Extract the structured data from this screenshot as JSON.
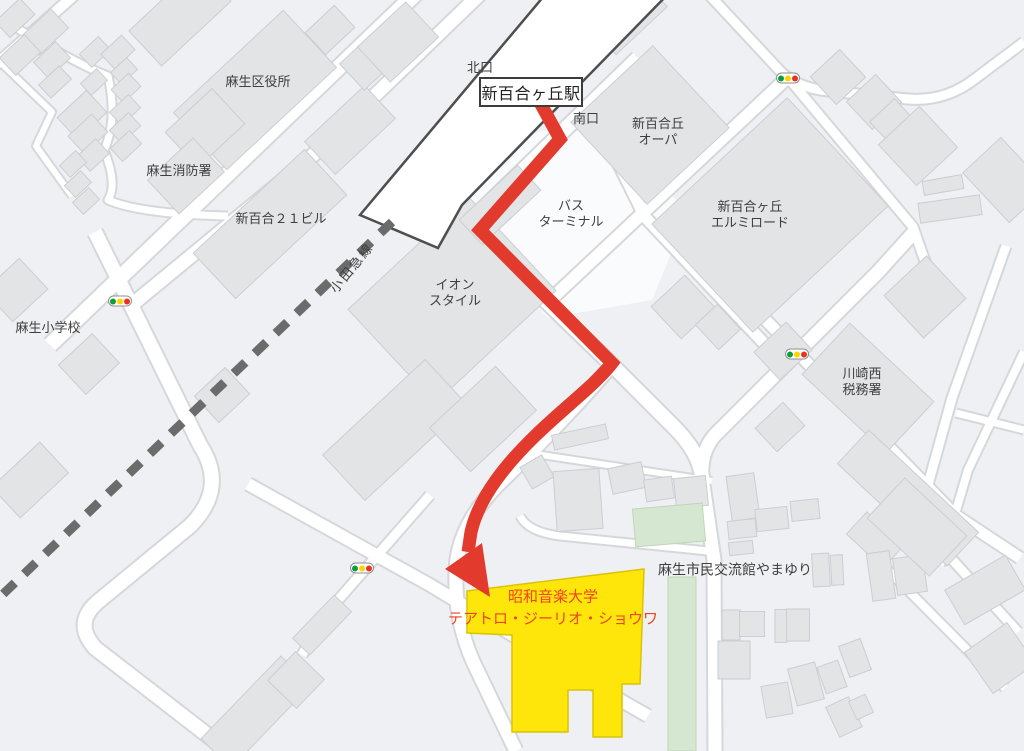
{
  "map_title": "新百合ヶ丘駅から昭和音楽大学への地図",
  "station": {
    "title": "新百合ヶ丘駅",
    "north_exit": "北口",
    "south_exit": "南口"
  },
  "labels": [
    {
      "name": "label-asao-ward-office",
      "lines": [
        "麻生区役所"
      ],
      "x": 258,
      "y": 82
    },
    {
      "name": "label-asao-fire-station",
      "lines": [
        "麻生消防署"
      ],
      "x": 179,
      "y": 171
    },
    {
      "name": "label-shinyuri-21-bldg",
      "lines": [
        "新百合２１ビル"
      ],
      "x": 281,
      "y": 219
    },
    {
      "name": "label-shinyuri-opa",
      "lines": [
        "新百合丘",
        "オーパ"
      ],
      "x": 658,
      "y": 132
    },
    {
      "name": "label-bus-terminal",
      "lines": [
        "バス",
        "ターミナル"
      ],
      "x": 571,
      "y": 214
    },
    {
      "name": "label-elmiroad",
      "lines": [
        "新百合ヶ丘",
        "エルミロード"
      ],
      "x": 750,
      "y": 215
    },
    {
      "name": "label-aeon-style",
      "lines": [
        "イオン",
        "スタイル"
      ],
      "x": 455,
      "y": 293
    },
    {
      "name": "label-odakyu-line",
      "lines": [
        "小田急線"
      ],
      "x": 352,
      "y": 268,
      "rotate": -51,
      "spacing": 2
    },
    {
      "name": "label-asao-elementary",
      "lines": [
        "麻生小学校"
      ],
      "x": 48,
      "y": 328
    },
    {
      "name": "label-kawasaki-tax-office",
      "lines": [
        "川崎西",
        "税務署"
      ],
      "x": 862,
      "y": 382,
      "align": "left"
    },
    {
      "name": "label-yamayuri-center",
      "lines": [
        "麻生市民交流館やまゆり"
      ],
      "x": 735,
      "y": 570,
      "size": 14
    },
    {
      "name": "label-destination",
      "lines": [
        "昭和音楽大学",
        "テアトロ・ジーリオ・ショウワ"
      ],
      "x": 553,
      "y": 608,
      "color": "#ee4424",
      "size": 15,
      "lh": 1.45
    }
  ],
  "traffic_lights": [
    {
      "x": 788,
      "y": 78
    },
    {
      "x": 120,
      "y": 301
    },
    {
      "x": 797,
      "y": 354
    },
    {
      "x": 362,
      "y": 568
    }
  ],
  "colors": {
    "route_red": "#e23a2c",
    "destination_yellow": "#ffe60a",
    "destination_text_red": "#ee4424",
    "railway_gray": "#6b6b6b",
    "building_gray": "#e2e4e6",
    "green_building": "#d5e7d1",
    "signal_green": "#0f9d3c",
    "signal_yellow": "#fdd400",
    "signal_red": "#e93322"
  }
}
